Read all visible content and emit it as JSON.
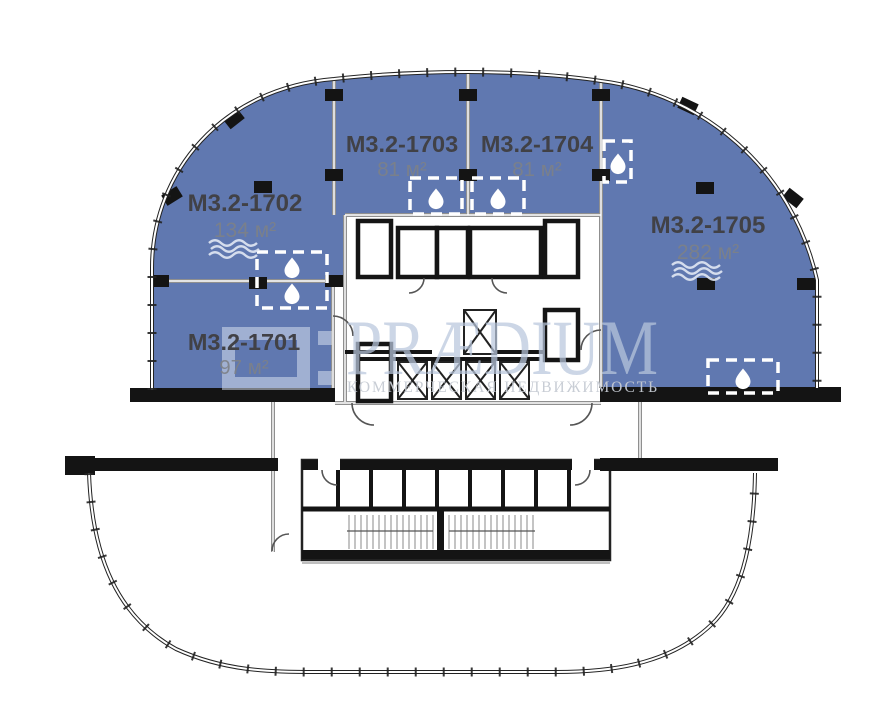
{
  "units": [
    {
      "name": "М3.2-1701",
      "area": "97 м²"
    },
    {
      "name": "М3.2-1702",
      "area": "134 м²"
    },
    {
      "name": "М3.2-1703",
      "area": "81 м²"
    },
    {
      "name": "М3.2-1704",
      "area": "81 м²"
    },
    {
      "name": "М3.2-1705",
      "area": "282 м²"
    }
  ],
  "watermark": {
    "brand": "PRÆDIUM",
    "tagline": "КОММЕРЧЕСКАЯ НЕДВИЖИМОСТЬ"
  },
  "icons": {
    "wet_point": "water-drop-icon",
    "water_line": "waves-icon"
  },
  "colors": {
    "unit_fill": "#6078B0",
    "wall_black": "#141414",
    "divider_gray": "#8F8F8F",
    "unit_name_text": "#414146",
    "unit_area_text": "#7D8187",
    "watermark_brand": "#B9C7DD",
    "watermark_tagline": "#C6CBD3",
    "facade": "#222222",
    "background": "#FFFFFF"
  }
}
